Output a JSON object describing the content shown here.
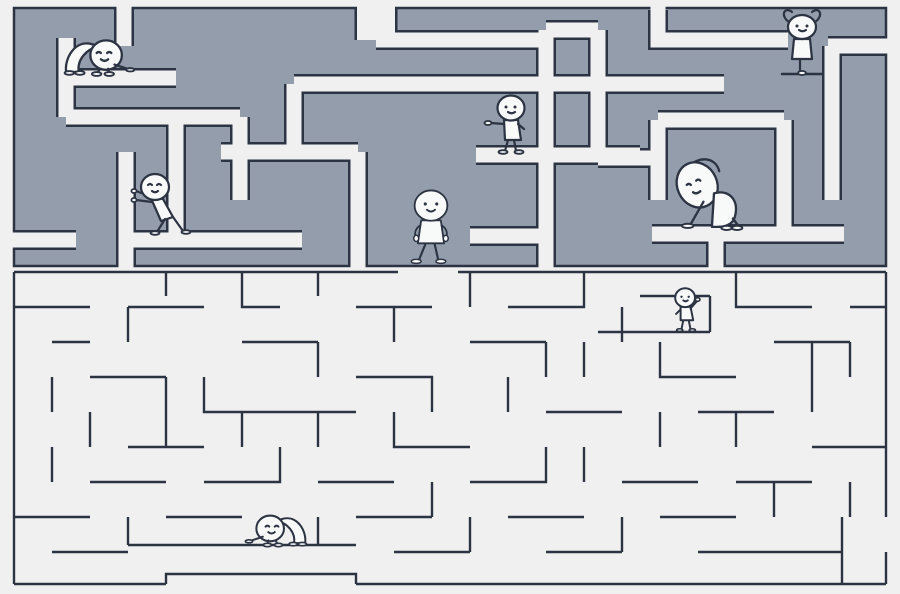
{
  "scene": {
    "width": 900,
    "height": 594,
    "kind": "double-maze-illustration"
  },
  "palette": {
    "background": "#f0f0f1",
    "upper_maze_fill": "#939dac",
    "wall_line": "#2c3342",
    "corridor": "#f0f0f1",
    "figure_fill": "#f8f9f9"
  },
  "upper_maze": {
    "style": "thick-gray-walls",
    "outer": {
      "x": 14,
      "y": 8,
      "w": 872,
      "h": 258
    },
    "lane_width": 15,
    "lanes": [
      {
        "points": [
          [
            66,
            38
          ],
          [
            66,
            117
          ]
        ]
      },
      {
        "points": [
          [
            66,
            78
          ],
          [
            176,
            78
          ]
        ]
      },
      {
        "points": [
          [
            66,
            117
          ],
          [
            240,
            117
          ]
        ]
      },
      {
        "points": [
          [
            176,
            117
          ],
          [
            176,
            240
          ]
        ]
      },
      {
        "points": [
          [
            14,
            240
          ],
          [
            76,
            240
          ]
        ],
        "open_start": true
      },
      {
        "points": [
          [
            126,
            152
          ],
          [
            126,
            266
          ]
        ],
        "open_end": true
      },
      {
        "points": [
          [
            124,
            8
          ],
          [
            124,
            46
          ]
        ],
        "open_start": true
      },
      {
        "points": [
          [
            126,
            240
          ],
          [
            302,
            240
          ]
        ]
      },
      {
        "points": [
          [
            240,
            117
          ],
          [
            240,
            200
          ]
        ]
      },
      {
        "points": [
          [
            221,
            152
          ],
          [
            358,
            152
          ]
        ]
      },
      {
        "points": [
          [
            358,
            152
          ],
          [
            358,
            266
          ]
        ],
        "open_end": true
      },
      {
        "points": [
          [
            376,
            8
          ],
          [
            376,
            40
          ]
        ],
        "open_start": true,
        "width": 38
      },
      {
        "points": [
          [
            376,
            40
          ],
          [
            546,
            40
          ]
        ]
      },
      {
        "points": [
          [
            546,
            30
          ],
          [
            546,
            266
          ]
        ],
        "open_end": true
      },
      {
        "points": [
          [
            476,
            155
          ],
          [
            640,
            155
          ]
        ]
      },
      {
        "points": [
          [
            470,
            236
          ],
          [
            548,
            236
          ]
        ]
      },
      {
        "points": [
          [
            294,
            84
          ],
          [
            724,
            84
          ]
        ]
      },
      {
        "points": [
          [
            294,
            84
          ],
          [
            294,
            152
          ]
        ]
      },
      {
        "points": [
          [
            546,
            30
          ],
          [
            598,
            30
          ]
        ]
      },
      {
        "points": [
          [
            598,
            30
          ],
          [
            598,
            158
          ]
        ]
      },
      {
        "points": [
          [
            598,
            158
          ],
          [
            658,
            158
          ]
        ]
      },
      {
        "points": [
          [
            658,
            10
          ],
          [
            658,
            40
          ],
          [
            788,
            40
          ]
        ],
        "open_start": true
      },
      {
        "points": [
          [
            658,
            120
          ],
          [
            784,
            120
          ]
        ]
      },
      {
        "points": [
          [
            658,
            120
          ],
          [
            658,
            200
          ]
        ]
      },
      {
        "points": [
          [
            784,
            120
          ],
          [
            784,
            234
          ]
        ]
      },
      {
        "points": [
          [
            652,
            234
          ],
          [
            844,
            234
          ]
        ]
      },
      {
        "points": [
          [
            716,
            234
          ],
          [
            716,
            266
          ]
        ],
        "open_end": true
      },
      {
        "points": [
          [
            828,
            46
          ],
          [
            886,
            46
          ]
        ],
        "open_end": true
      },
      {
        "points": [
          [
            832,
            46
          ],
          [
            832,
            200
          ]
        ]
      }
    ]
  },
  "lower_maze": {
    "style": "thin-line-walls",
    "line_width": 2.4,
    "walls": [
      [
        [
          14,
          272
        ],
        [
          398,
          272
        ]
      ],
      [
        [
          458,
          272
        ],
        [
          886,
          272
        ]
      ],
      [
        [
          14,
          272
        ],
        [
          14,
          584
        ]
      ],
      [
        [
          886,
          272
        ],
        [
          886,
          517
        ]
      ],
      [
        [
          886,
          552
        ],
        [
          886,
          584
        ]
      ],
      [
        [
          14,
          584
        ],
        [
          166,
          584
        ]
      ],
      [
        [
          166,
          584
        ],
        [
          166,
          574
        ],
        [
          356,
          574
        ],
        [
          356,
          584
        ]
      ],
      [
        [
          356,
          584
        ],
        [
          886,
          584
        ]
      ],
      [
        [
          166,
          272
        ],
        [
          166,
          296
        ]
      ],
      [
        [
          14,
          307
        ],
        [
          90,
          307
        ]
      ],
      [
        [
          128,
          307
        ],
        [
          204,
          307
        ]
      ],
      [
        [
          128,
          307
        ],
        [
          128,
          342
        ]
      ],
      [
        [
          242,
          272
        ],
        [
          242,
          307
        ],
        [
          280,
          307
        ]
      ],
      [
        [
          318,
          272
        ],
        [
          318,
          296
        ]
      ],
      [
        [
          356,
          307
        ],
        [
          432,
          307
        ]
      ],
      [
        [
          394,
          307
        ],
        [
          394,
          342
        ]
      ],
      [
        [
          470,
          272
        ],
        [
          470,
          307
        ]
      ],
      [
        [
          508,
          307
        ],
        [
          584,
          307
        ],
        [
          584,
          272
        ]
      ],
      [
        [
          622,
          307
        ],
        [
          622,
          342
        ]
      ],
      [
        [
          640,
          296
        ],
        [
          710,
          296
        ]
      ],
      [
        [
          710,
          296
        ],
        [
          710,
          332
        ]
      ],
      [
        [
          598,
          332
        ],
        [
          710,
          332
        ]
      ],
      [
        [
          736,
          272
        ],
        [
          736,
          307
        ],
        [
          812,
          307
        ]
      ],
      [
        [
          850,
          307
        ],
        [
          886,
          307
        ]
      ],
      [
        [
          52,
          342
        ],
        [
          90,
          342
        ]
      ],
      [
        [
          242,
          342
        ],
        [
          318,
          342
        ]
      ],
      [
        [
          318,
          342
        ],
        [
          318,
          377
        ]
      ],
      [
        [
          470,
          342
        ],
        [
          546,
          342
        ]
      ],
      [
        [
          546,
          342
        ],
        [
          546,
          377
        ]
      ],
      [
        [
          660,
          342
        ],
        [
          660,
          377
        ],
        [
          736,
          377
        ]
      ],
      [
        [
          774,
          342
        ],
        [
          850,
          342
        ]
      ],
      [
        [
          52,
          377
        ],
        [
          52,
          412
        ]
      ],
      [
        [
          90,
          377
        ],
        [
          166,
          377
        ]
      ],
      [
        [
          166,
          377
        ],
        [
          166,
          447
        ]
      ],
      [
        [
          204,
          377
        ],
        [
          204,
          412
        ],
        [
          280,
          412
        ]
      ],
      [
        [
          356,
          377
        ],
        [
          432,
          377
        ],
        [
          432,
          412
        ]
      ],
      [
        [
          508,
          377
        ],
        [
          508,
          412
        ]
      ],
      [
        [
          584,
          342
        ],
        [
          584,
          377
        ]
      ],
      [
        [
          812,
          342
        ],
        [
          812,
          412
        ]
      ],
      [
        [
          850,
          342
        ],
        [
          850,
          377
        ]
      ],
      [
        [
          90,
          412
        ],
        [
          90,
          447
        ]
      ],
      [
        [
          128,
          447
        ],
        [
          204,
          447
        ]
      ],
      [
        [
          242,
          412
        ],
        [
          242,
          447
        ]
      ],
      [
        [
          280,
          412
        ],
        [
          356,
          412
        ]
      ],
      [
        [
          318,
          412
        ],
        [
          318,
          447
        ]
      ],
      [
        [
          394,
          412
        ],
        [
          394,
          447
        ],
        [
          470,
          447
        ]
      ],
      [
        [
          546,
          412
        ],
        [
          622,
          412
        ]
      ],
      [
        [
          660,
          412
        ],
        [
          660,
          447
        ]
      ],
      [
        [
          698,
          412
        ],
        [
          774,
          412
        ]
      ],
      [
        [
          736,
          412
        ],
        [
          736,
          447
        ]
      ],
      [
        [
          812,
          447
        ],
        [
          886,
          447
        ]
      ],
      [
        [
          52,
          447
        ],
        [
          52,
          482
        ]
      ],
      [
        [
          90,
          482
        ],
        [
          166,
          482
        ]
      ],
      [
        [
          204,
          482
        ],
        [
          280,
          482
        ],
        [
          280,
          447
        ]
      ],
      [
        [
          318,
          482
        ],
        [
          394,
          482
        ]
      ],
      [
        [
          432,
          482
        ],
        [
          432,
          517
        ]
      ],
      [
        [
          470,
          482
        ],
        [
          546,
          482
        ],
        [
          546,
          447
        ]
      ],
      [
        [
          584,
          447
        ],
        [
          584,
          482
        ]
      ],
      [
        [
          622,
          482
        ],
        [
          698,
          482
        ]
      ],
      [
        [
          736,
          482
        ],
        [
          812,
          482
        ]
      ],
      [
        [
          774,
          482
        ],
        [
          774,
          517
        ]
      ],
      [
        [
          850,
          482
        ],
        [
          850,
          517
        ]
      ],
      [
        [
          14,
          517
        ],
        [
          90,
          517
        ]
      ],
      [
        [
          128,
          517
        ],
        [
          128,
          545
        ]
      ],
      [
        [
          166,
          517
        ],
        [
          242,
          517
        ]
      ],
      [
        [
          318,
          517
        ],
        [
          318,
          545
        ]
      ],
      [
        [
          128,
          545
        ],
        [
          356,
          545
        ]
      ],
      [
        [
          356,
          517
        ],
        [
          432,
          517
        ]
      ],
      [
        [
          470,
          517
        ],
        [
          470,
          552
        ]
      ],
      [
        [
          508,
          517
        ],
        [
          584,
          517
        ]
      ],
      [
        [
          622,
          517
        ],
        [
          622,
          552
        ]
      ],
      [
        [
          660,
          517
        ],
        [
          736,
          517
        ]
      ],
      [
        [
          52,
          552
        ],
        [
          128,
          552
        ]
      ],
      [
        [
          394,
          552
        ],
        [
          470,
          552
        ]
      ],
      [
        [
          546,
          552
        ],
        [
          622,
          552
        ]
      ],
      [
        [
          698,
          552
        ],
        [
          774,
          552
        ]
      ],
      [
        [
          774,
          552
        ],
        [
          842,
          552
        ]
      ],
      [
        [
          842,
          517
        ],
        [
          842,
          584
        ]
      ]
    ]
  },
  "characters": [
    {
      "id": "figure-crawling-upper-left",
      "pose": "crawl",
      "x": 104,
      "y": 74,
      "scale": 1.05,
      "flip": false
    },
    {
      "id": "figure-pushing-wall",
      "pose": "push",
      "x": 160,
      "y": 233,
      "scale": 1.0,
      "flip": false
    },
    {
      "id": "figure-pointing",
      "pose": "point",
      "x": 511,
      "y": 153,
      "scale": 1.0,
      "flip": false
    },
    {
      "id": "figure-yoga-tree",
      "pose": "yoga",
      "x": 802,
      "y": 74,
      "scale": 1.0,
      "flip": false
    },
    {
      "id": "figure-walking-center",
      "pose": "walk",
      "x": 431,
      "y": 263,
      "scale": 0.82,
      "flip": false
    },
    {
      "id": "figure-side-stretch",
      "pose": "stretch",
      "x": 714,
      "y": 229,
      "scale": 1.05,
      "flip": false
    },
    {
      "id": "figure-waving",
      "pose": "wave",
      "x": 686,
      "y": 331,
      "scale": 0.9,
      "flip": false
    },
    {
      "id": "figure-crawling-lower-left",
      "pose": "crawl",
      "x": 272,
      "y": 545,
      "scale": 0.92,
      "flip": true
    }
  ]
}
